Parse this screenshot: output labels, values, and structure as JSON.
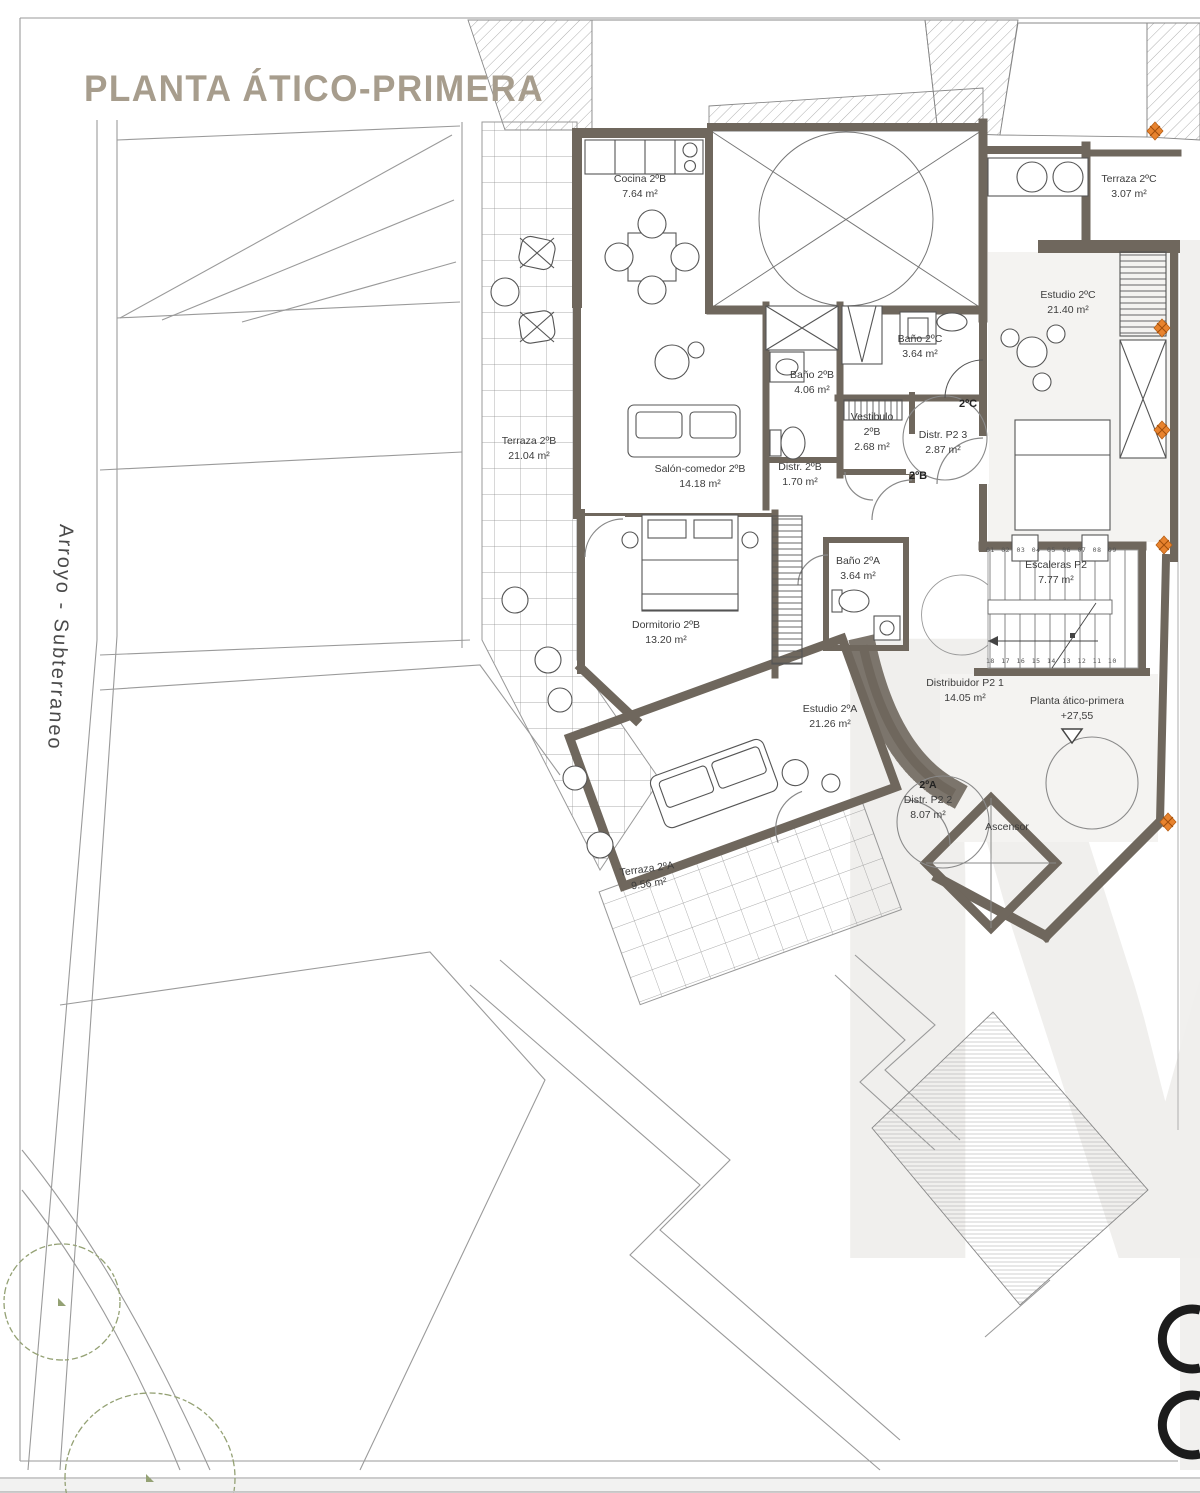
{
  "title": "PLANTA ÁTICO-PRIMERA",
  "site": {
    "street_label": "Arroyo - Subterraneo"
  },
  "units": {
    "a": "2ºA",
    "b": "2ºB",
    "c": "2ºC"
  },
  "rooms": {
    "cocina_2b": {
      "name": "Cocina 2ºB",
      "area": "7.64 m²"
    },
    "terraza_2c": {
      "name": "Terraza 2ºC",
      "area": "3.07 m²"
    },
    "estudio_2c": {
      "name": "Estudio 2ºC",
      "area": "21.40 m²"
    },
    "bano_2c": {
      "name": "Baño 2ºC",
      "area": "3.64 m²"
    },
    "bano_2b": {
      "name": "Baño 2ºB",
      "area": "4.06 m²"
    },
    "vestibulo_2b": {
      "name": "Vestibulo 2ºB",
      "area": "2.68 m²"
    },
    "distr_p2_3": {
      "name": "Distr. P2 3",
      "area": "2.87 m²"
    },
    "distr_2b": {
      "name": "Distr. 2ºB",
      "area": "1.70 m²"
    },
    "salon_comedor_2b": {
      "name": "Salón-comedor 2ºB",
      "area": "14.18 m²"
    },
    "terraza_2b": {
      "name": "Terraza 2ºB",
      "area": "21.04 m²"
    },
    "dormitorio_2b": {
      "name": "Dormitorio 2ºB",
      "area": "13.20 m²"
    },
    "bano_2a": {
      "name": "Baño 2ºA",
      "area": "3.64 m²"
    },
    "escaleras_p2": {
      "name": "Escaleras P2",
      "area": "7.77 m²"
    },
    "distribuidor_p2_1": {
      "name": "Distribuidor P2 1",
      "area": "14.05 m²"
    },
    "estudio_2a": {
      "name": "Estudio 2ºA",
      "area": "21.26 m²"
    },
    "distr_p2_2": {
      "name": "Distr. P2 2",
      "area": "8.07 m²"
    },
    "ascensor": {
      "name": "Ascensor"
    },
    "terraza_2a": {
      "name": "Terraza 2ºA",
      "area": "9.56 m²"
    }
  },
  "level_marker": {
    "label": "Planta ático-primera",
    "value": "+27,55"
  },
  "stairs": {
    "top_numbers": "01 02 03 04 05 06 07 08 09",
    "bottom_numbers": "18 17 16 15 14 13 12 11 10"
  },
  "colors": {
    "wall": "#6f675d",
    "title_text": "#a79d8d",
    "survey_marker": "#e8832e",
    "tree": "#94a174"
  }
}
